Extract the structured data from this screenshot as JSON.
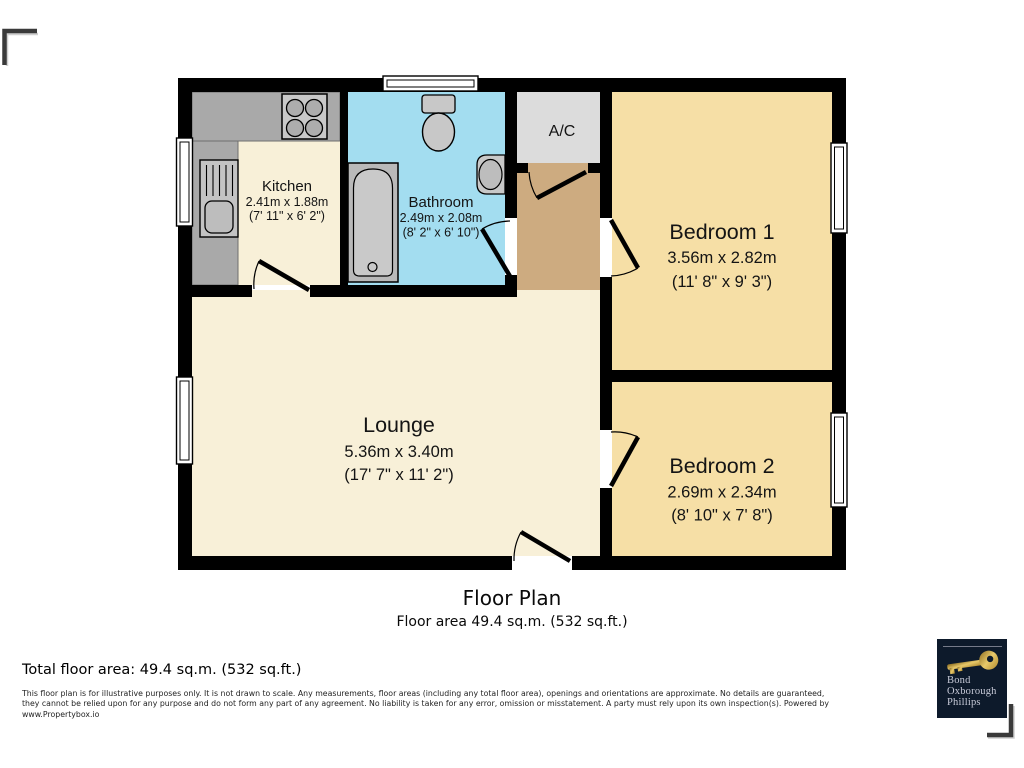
{
  "plan": {
    "title": "Floor Plan",
    "subtitle": "Floor area 49.4 sq.m. (532 sq.ft.)"
  },
  "rooms": {
    "kitchen": {
      "name": "Kitchen",
      "metric": "2.41m x 1.88m",
      "imperial": "(7' 11\" x 6' 2\")"
    },
    "bathroom": {
      "name": "Bathroom",
      "metric": "2.49m x 2.08m",
      "imperial": "(8' 2\" x 6' 10\")"
    },
    "ac": {
      "name": "A/C"
    },
    "bedroom1": {
      "name": "Bedroom 1",
      "metric": "3.56m x 2.82m",
      "imperial": "(11' 8\" x 9' 3\")"
    },
    "bedroom2": {
      "name": "Bedroom 2",
      "metric": "2.69m x 2.34m",
      "imperial": "(8' 10\" x 7' 8\")"
    },
    "lounge": {
      "name": "Lounge",
      "metric": "5.36m x 3.40m",
      "imperial": "(17' 7\" x 11' 2\")"
    }
  },
  "footer": {
    "total_area": "Total floor area: 49.4 sq.m. (532 sq.ft.)",
    "disclaimer_lines": [
      "This floor plan is for illustrative purposes only. It is not drawn to scale. Any measurements, floor areas (including any total floor area), openings and orientations are approximate. No details are guaranteed,",
      "they cannot be relied upon for any purpose and do not form any part of any agreement. No liability is taken for any error, omission or misstatement. A party must rely upon its own inspection(s). Powered by",
      "www.Propertybox.io"
    ]
  },
  "logo": {
    "lines": [
      "Bond",
      "Oxborough",
      "Phillips"
    ]
  },
  "colors": {
    "wall": "#000000",
    "cream": "#f8f0d8",
    "bedroom": "#f6dfa6",
    "hall": "#cdab80",
    "bathroom": "#a3ddf0",
    "ac_closet": "#dcdcdc",
    "counter": "#a9a9a9",
    "fixture": "#c8c8c8",
    "logo_bg": "#0d1a2b",
    "logo_gold": "#d4af5a"
  }
}
